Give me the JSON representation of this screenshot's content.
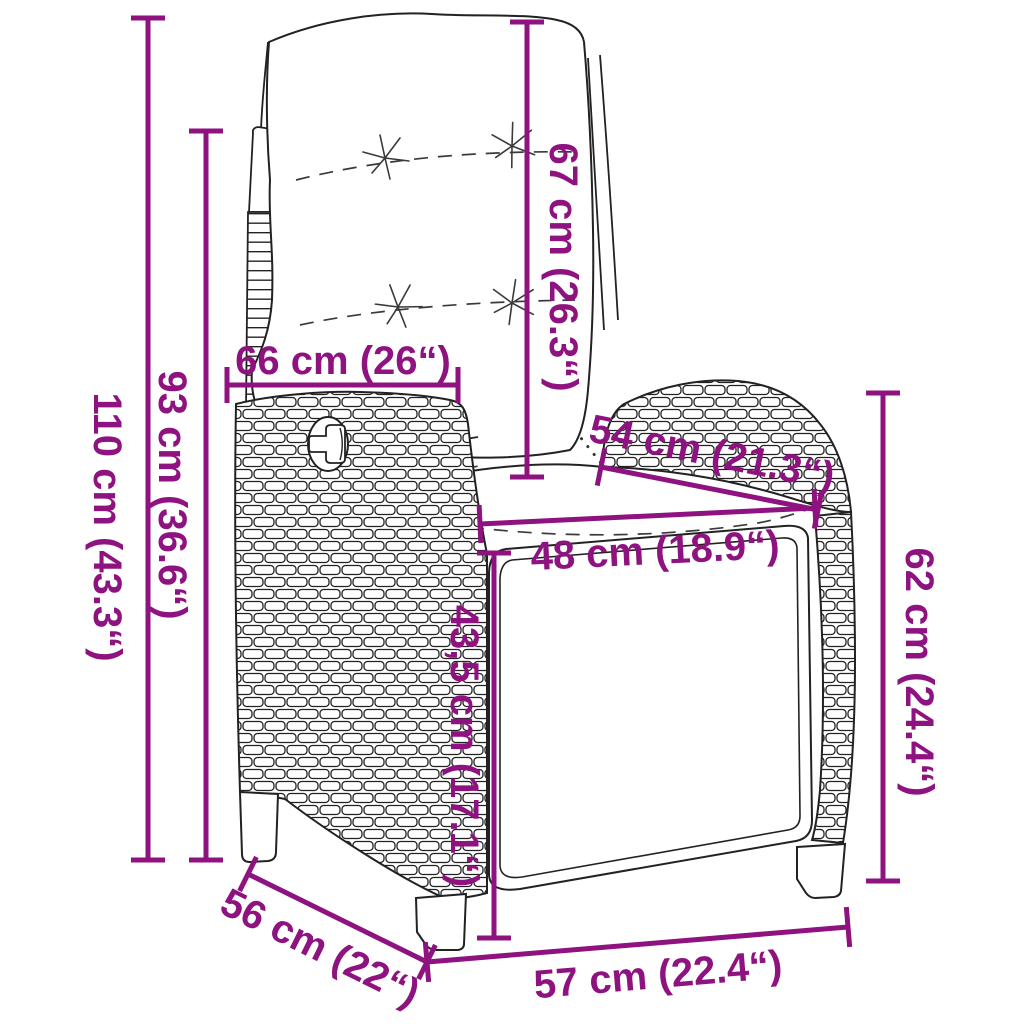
{
  "page": {
    "background": "#ffffff"
  },
  "diagram": {
    "title": "Reclining garden chair with cushions — dimension diagram",
    "accent_color": "#8E127F",
    "outline_color": "#222222",
    "dimensions": [
      {
        "id": "total-height",
        "label": "110 cm (43.3“)",
        "orientation": "vertical"
      },
      {
        "id": "backrest-height",
        "label": "93 cm (36.6“)",
        "orientation": "vertical"
      },
      {
        "id": "backrest-width",
        "label": "66 cm (26“)",
        "orientation": "horizontal"
      },
      {
        "id": "backrest-cushion-length",
        "label": "67 cm (26.3“)",
        "orientation": "vertical"
      },
      {
        "id": "armrest-length",
        "label": "54 cm (21.3“)",
        "orientation": "diagonal"
      },
      {
        "id": "seat-width",
        "label": "48 cm (18.9“)",
        "orientation": "horizontal"
      },
      {
        "id": "seat-height",
        "label": "43,5 cm (17.1“)",
        "orientation": "vertical"
      },
      {
        "id": "armrest-height",
        "label": "62 cm (24.4“)",
        "orientation": "vertical"
      },
      {
        "id": "seat-depth",
        "label": "56 cm (22“)",
        "orientation": "diagonal"
      },
      {
        "id": "base-width",
        "label": "57 cm (22.4“)",
        "orientation": "horizontal"
      }
    ]
  }
}
